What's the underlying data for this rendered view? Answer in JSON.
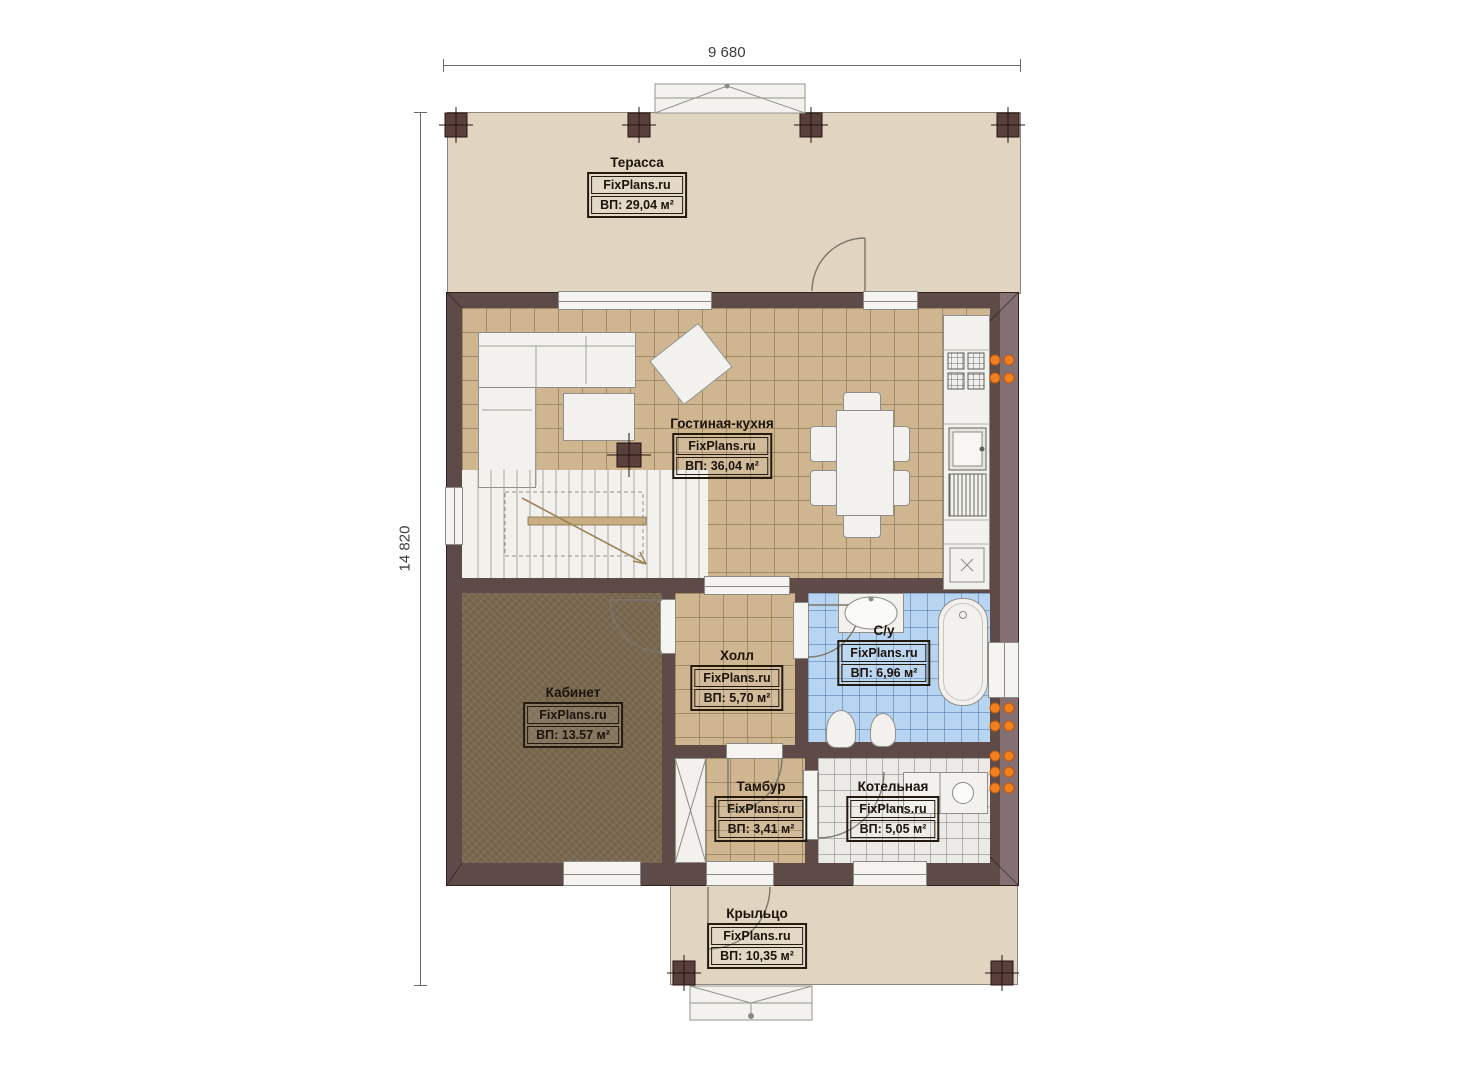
{
  "plan": {
    "dimensions": {
      "width_label": "9 680",
      "height_label": "14 820"
    },
    "brand": "FixPlans.ru"
  },
  "rooms": [
    {
      "id": "terrace",
      "name": "Терасса",
      "area": "ВП: 29,04 м²"
    },
    {
      "id": "living",
      "name": "Гостиная-кухня",
      "area": "ВП: 36,04 м²"
    },
    {
      "id": "office",
      "name": "Кабинет",
      "area": "ВП: 13.57 м²"
    },
    {
      "id": "hall",
      "name": "Холл",
      "area": "ВП: 5,70 м²"
    },
    {
      "id": "bathroom",
      "name": "С/у",
      "area": "ВП: 6,96 м²"
    },
    {
      "id": "vestibule",
      "name": "Тамбур",
      "area": "ВП: 3,41 м²"
    },
    {
      "id": "boiler",
      "name": "Котельная",
      "area": "ВП: 5,05 м²"
    },
    {
      "id": "porch",
      "name": "Крыльцо",
      "area": "ВП: 10,35 м²"
    }
  ],
  "colors": {
    "wall": "#5e4b48",
    "deck_floor": "#e1d4c0",
    "tile_floor": "#cfb590",
    "office_floor": "#7b6950",
    "bathroom_floor": "#b7d4f0",
    "boiler_floor": "#eceae7",
    "heater": "#f1801f"
  }
}
